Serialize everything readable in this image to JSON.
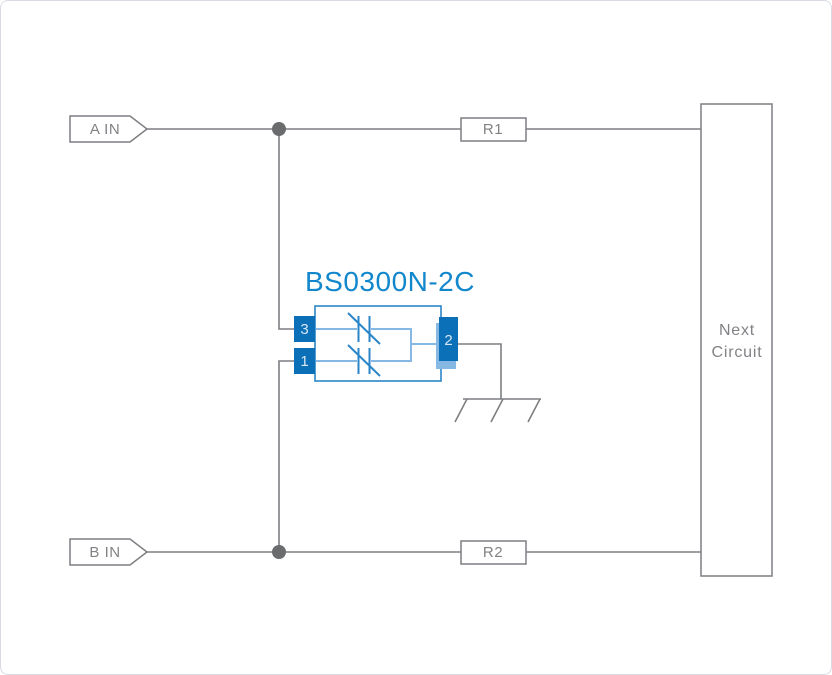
{
  "colors": {
    "canvas_border": "#d8dce2",
    "wire_gray": "#7d7f82",
    "text_gray": "#808285",
    "dot_gray": "#6a6c6e",
    "component_blue": "#2b86c8",
    "wire_blue_light": "#85b9e4",
    "pin_blue": "#0b70b8",
    "pin_label_light": "#d9e7f4",
    "title_blue": "#1287cc"
  },
  "diagram": {
    "title": "BS0300N-2C",
    "input_a": "A IN",
    "input_b": "B IN",
    "resistor_1": "R1",
    "resistor_2": "R2",
    "next_circuit_line1": "Next",
    "next_circuit_line2": "Circuit",
    "pin_3": "3",
    "pin_1": "1",
    "pin_2": "2"
  }
}
